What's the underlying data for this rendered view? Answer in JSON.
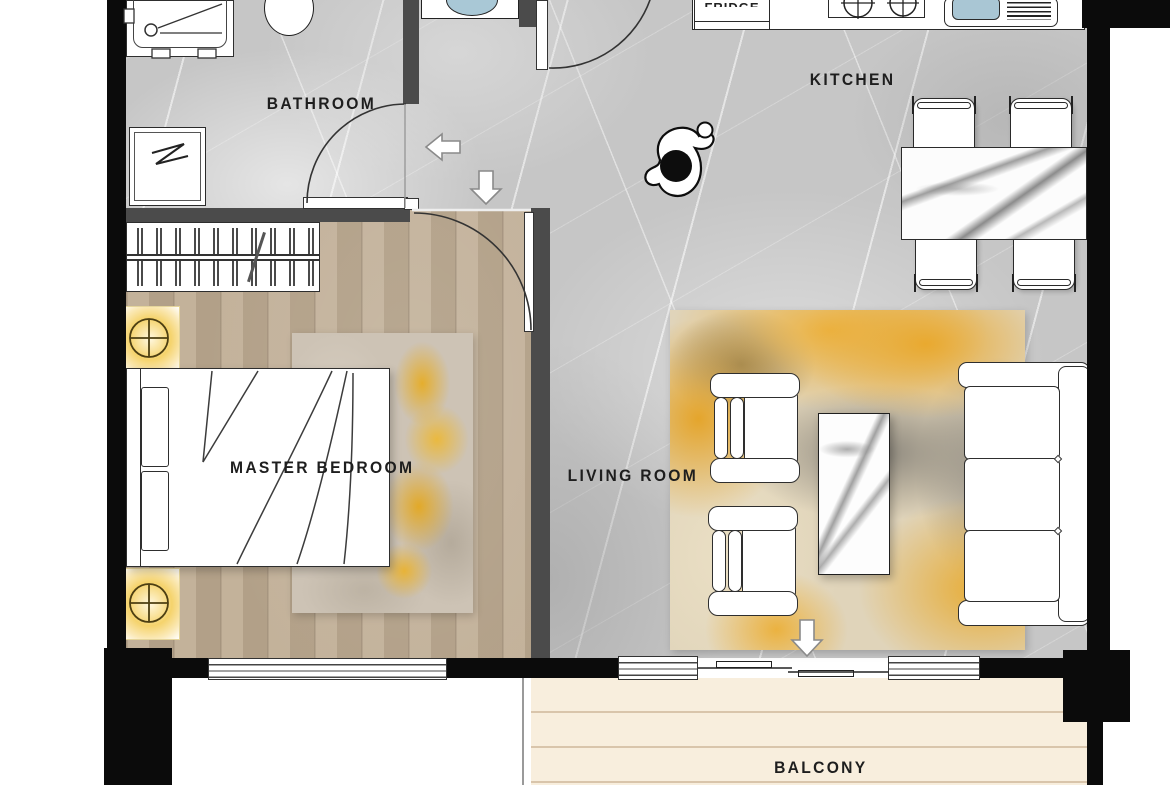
{
  "rooms": {
    "bathroom": {
      "label": "BATHROOM"
    },
    "kitchen": {
      "label": "KITCHEN"
    },
    "living_room": {
      "label": "LIVING ROOM"
    },
    "master_bedroom": {
      "label": "MASTER BEDROOM"
    },
    "balcony": {
      "label": "BALCONY"
    }
  },
  "appliances": {
    "fridge_label": "FRIDGE"
  },
  "colors": {
    "accent_yellow": "#e9ae35",
    "marble_floor": "#c6c6c6",
    "wood_floor": "#bca98f",
    "balcony_deck": "#f8eedd",
    "wall_black": "#0b0b0b",
    "wall_gray": "#4b4b4b",
    "sink_blue": "#a9c6d4",
    "lamp_glow": "#f5d36c"
  }
}
